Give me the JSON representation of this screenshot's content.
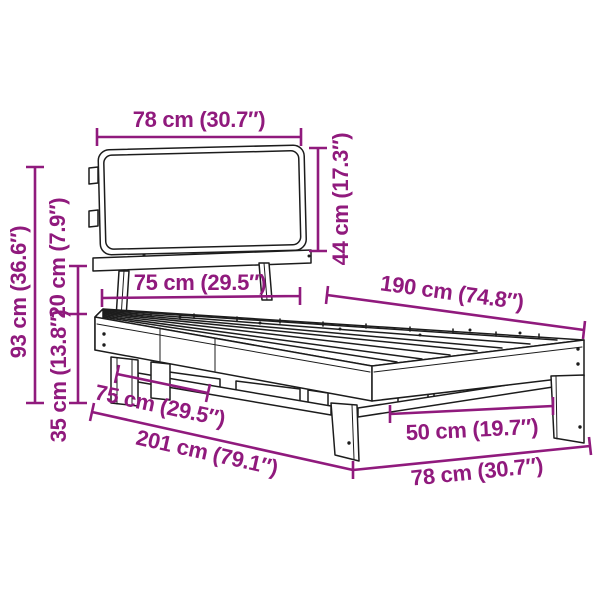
{
  "colors": {
    "accent": "#901A7D",
    "outline": "#1C1C1C",
    "background": "#FFFFFF"
  },
  "dimensions": {
    "headboard_width": "78 cm (30.7″)",
    "headboard_height": "44 cm (17.3″)",
    "total_height": "93 cm (36.6″)",
    "frame_gap_height": "20 cm (7.9″)",
    "base_height": "35 cm (13.8″)",
    "slat_area_width": "75 cm (29.5″)",
    "slat_area_length": "190 cm (74.8″)",
    "base_width": "75 cm (29.5″)",
    "total_length": "201 cm (79.1″)",
    "leg_spacing": "50 cm (19.7″)",
    "foot_end_width": "78 cm (30.7″)"
  }
}
